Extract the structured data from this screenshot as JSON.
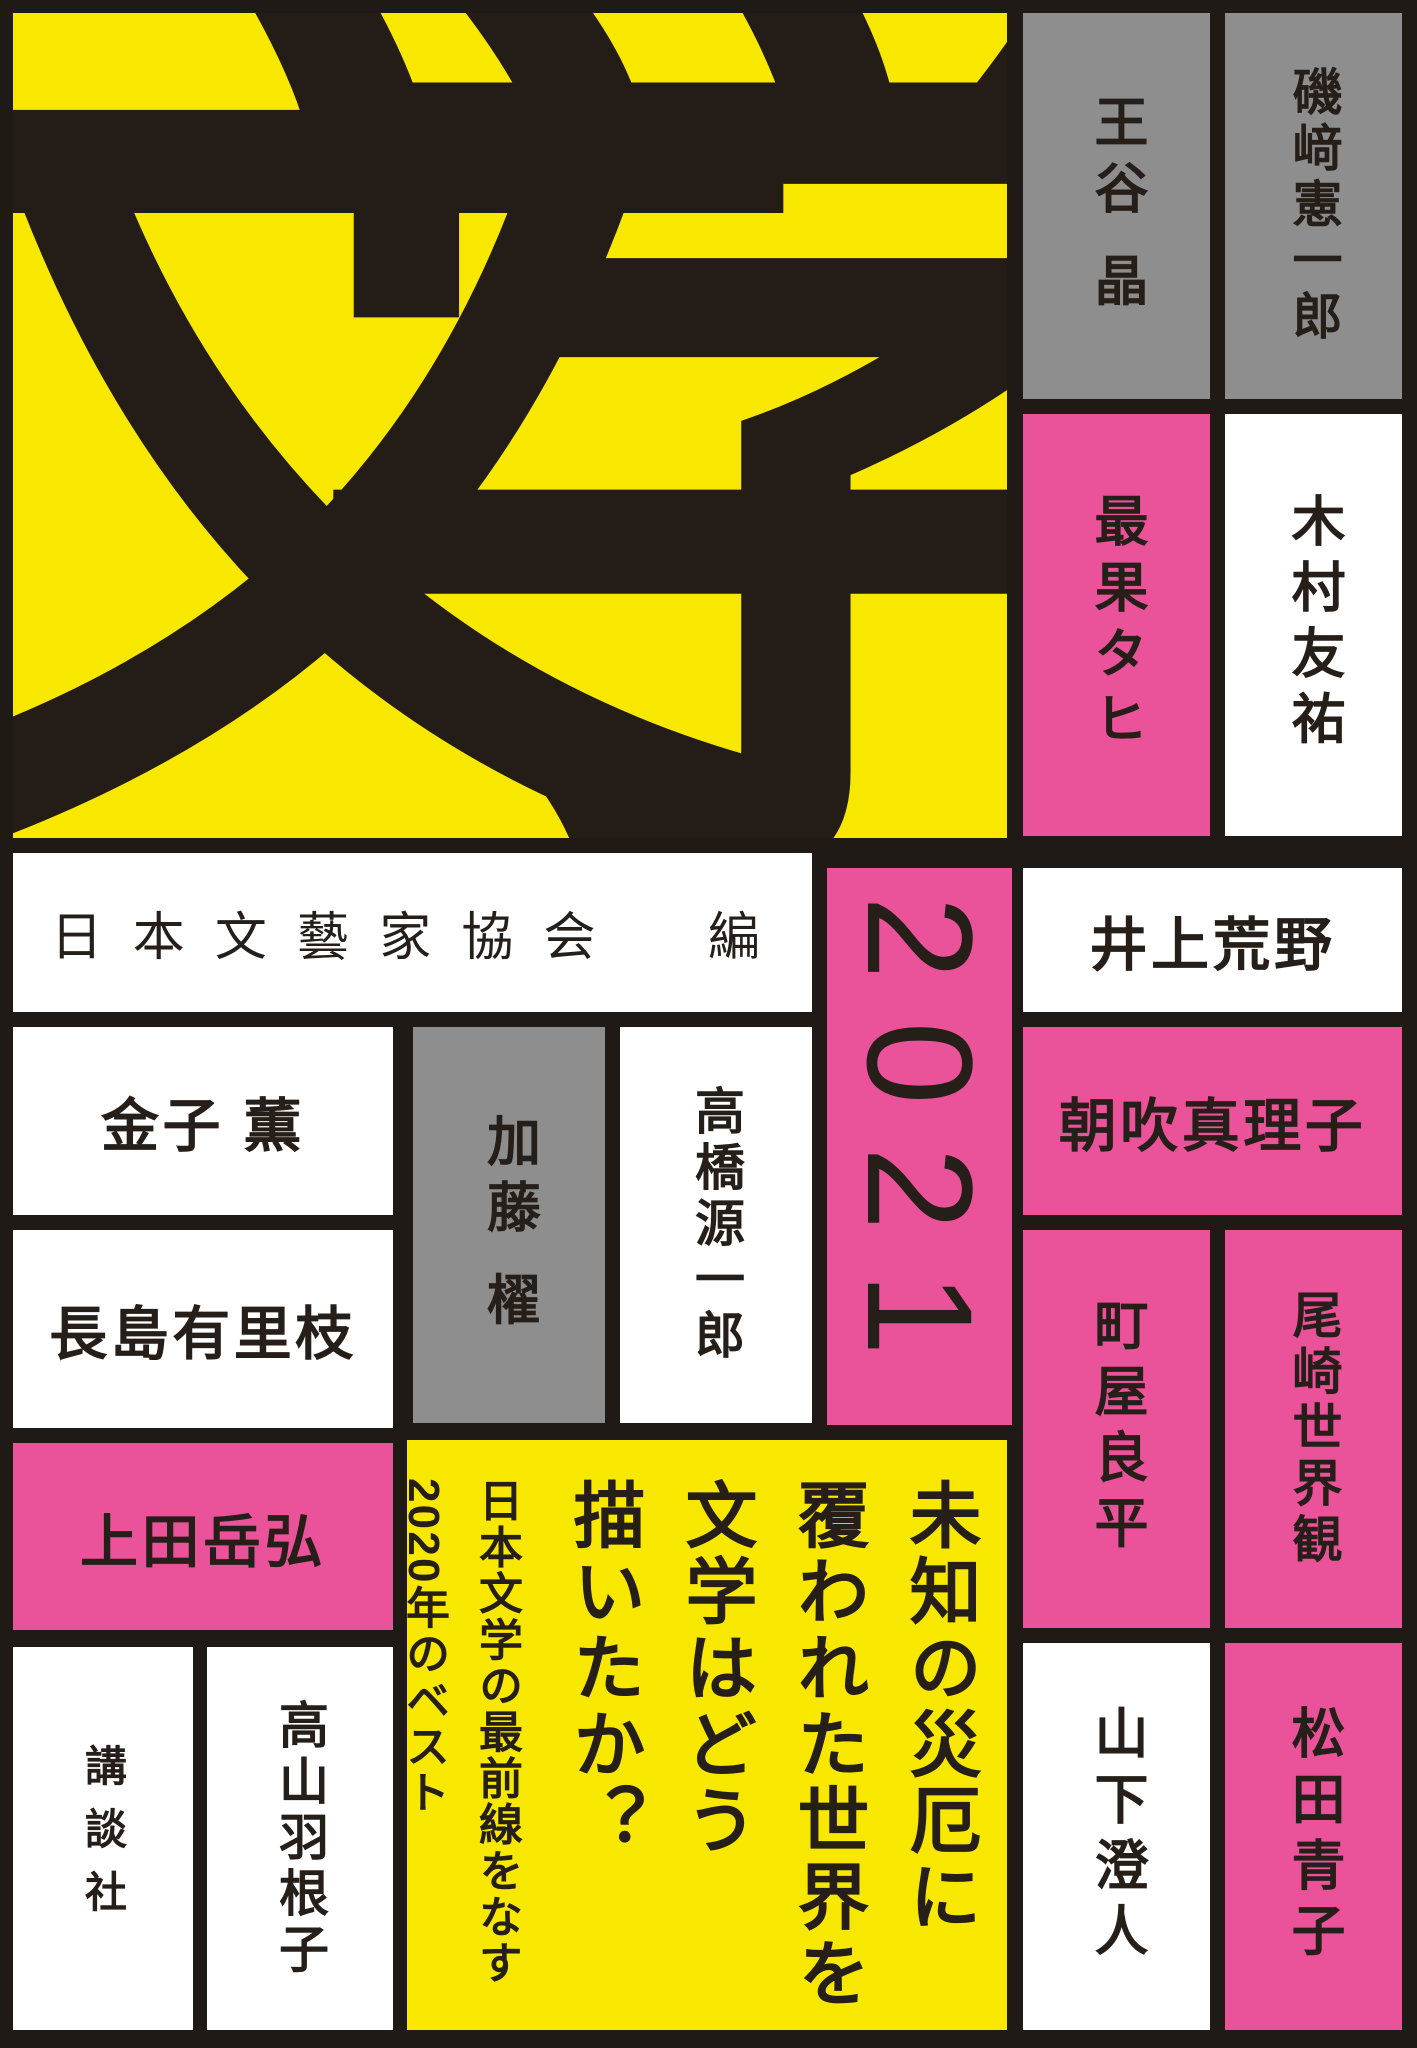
{
  "cover": {
    "title": {
      "char1": "文",
      "char2": "学"
    },
    "year": "2021",
    "editor": "日本文藝家協会　編",
    "publisher": "講談社",
    "authors": {
      "otani": "王谷 晶",
      "isozaki": "磯﨑憲一郎",
      "saihate": "最果タヒ",
      "kimura": "木村友祐",
      "inoue": "井上荒野",
      "asabuki": "朝吹真理子",
      "kaneko": "金子 薫",
      "kato": "加藤 櫂",
      "takahashi": "高橋源一郎",
      "nagashima": "長島有里枝",
      "machiya": "町屋良平",
      "ozaki": "尾崎世界観",
      "ueda": "上田岳弘",
      "takayama": "高山羽根子",
      "yamashita": "山下澄人",
      "matsuda": "松田青子"
    },
    "catchcopy": {
      "line1": "未知の災厄に",
      "line2": "覆われた世界を",
      "line3": "文学はどう",
      "line4": "描いたか？",
      "sub1": "日本文学の最前線をなす",
      "sub2": "2020年のベスト",
      "sub3": "短篇小説アンソロジー",
      "kaisetsu_label": "解説",
      "kaisetsu_name": "富岡幸一郎"
    },
    "colors": {
      "yellow": "#f8e800",
      "pink": "#ea5299",
      "gray": "#8e8e8e",
      "white": "#ffffff",
      "frame_black": "#201a16",
      "text_black": "#261e18"
    }
  }
}
